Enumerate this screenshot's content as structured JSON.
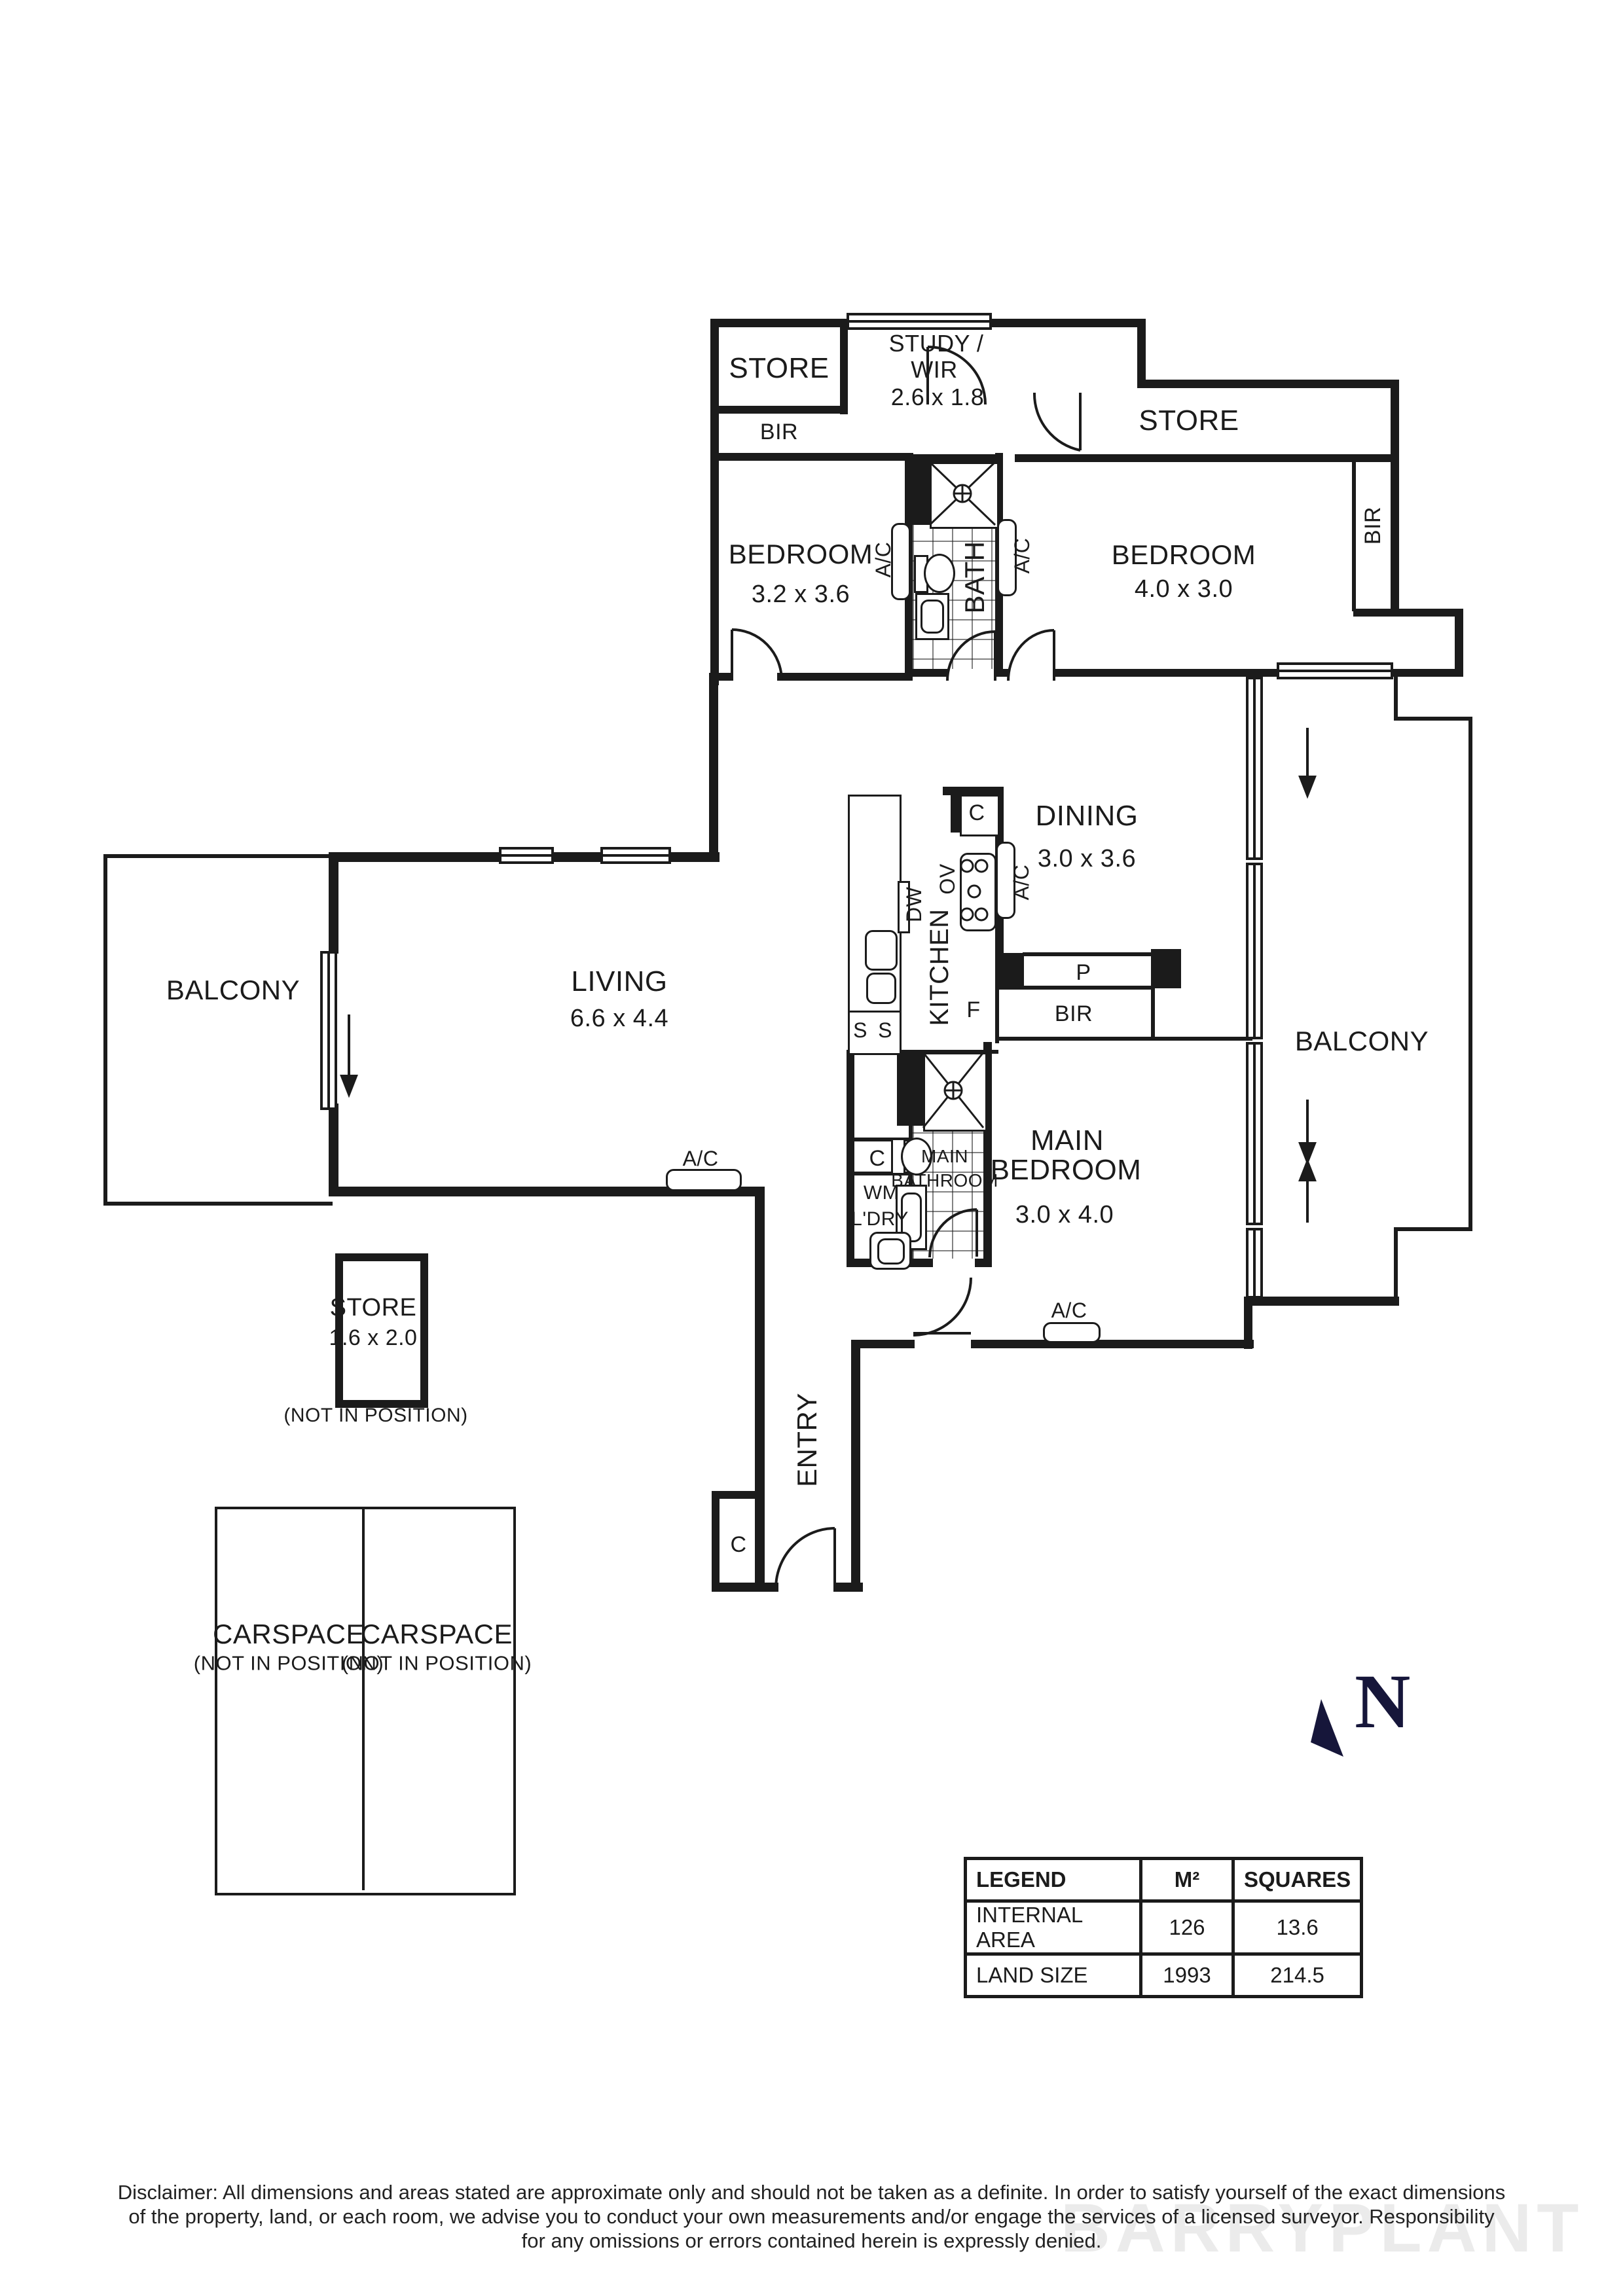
{
  "labels": {
    "store_top_left": "STORE",
    "bir_top_left": "BIR",
    "study_line1": "STUDY /",
    "study_line2": "WIR",
    "study_dims": "2.6 x 1.8",
    "store_top_right": "STORE",
    "bir_right": "BIR",
    "bedroom_left": "BEDROOM",
    "bedroom_left_dims": "3.2 x 3.6",
    "bedroom_right": "BEDROOM",
    "bedroom_right_dims": "4.0 x 3.0",
    "ac_bath_left": "A/C",
    "bath": "BATH",
    "ac_bath_right": "A/C",
    "dining": "DINING",
    "dining_dims": "3.0 x 3.6",
    "cupboard_kitchen": "C",
    "oven": "OV",
    "dishwasher": "DW",
    "kitchen": "KITCHEN",
    "ac_dining": "A/C",
    "fridge": "F",
    "sink_left": "S",
    "sink_right": "S",
    "pantry": "P",
    "bir_main": "BIR",
    "balcony_left": "BALCONY",
    "living": "LIVING",
    "living_dims": "6.6 x 4.4",
    "balcony_right": "BALCONY",
    "ac_living": "A/C",
    "main_bedroom_line1": "MAIN",
    "main_bedroom_line2": "BEDROOM",
    "main_bedroom_dims": "3.0 x 4.0",
    "main_bathroom_line1": "MAIN",
    "main_bathroom_line2": "BATHROOM",
    "cupboard_laundry": "C",
    "washing_machine": "WM",
    "laundry": "L'DRY",
    "ac_main_bedroom": "A/C",
    "entry": "ENTRY",
    "cupboard_entry": "C",
    "store_small": "STORE",
    "store_small_dims": "1.6 x 2.0",
    "store_small_note": "(NOT IN POSITION)",
    "carspace_1": "CARSPACE",
    "carspace_1_note": "(NOT IN POSITION)",
    "carspace_2": "CARSPACE",
    "carspace_2_note": "(NOT IN POSITION)",
    "north": "N"
  },
  "legend": {
    "headers": [
      "LEGEND",
      "M²",
      "SQUARES"
    ],
    "rows": [
      {
        "label": "INTERNAL AREA",
        "m2": "126",
        "squares": "13.6"
      },
      {
        "label": "LAND SIZE",
        "m2": "1993",
        "squares": "214.5"
      }
    ]
  },
  "disclaimer": {
    "line1": "Disclaimer: All dimensions and areas stated are approximate only and should not be taken as a definite. In order to satisfy yourself of the exact dimensions",
    "line2": "of the property, land, or each room, we advise you to conduct your own measurements and/or engage the services of a licensed surveyor. Responsibility",
    "line3": "for any omissions or errors contained herein is expressly denied."
  },
  "watermark": "BARRYPLANT",
  "colors": {
    "wall": "#1b1b1b",
    "north_arrow": "#16163a",
    "watermark": "#dcdcdc"
  }
}
